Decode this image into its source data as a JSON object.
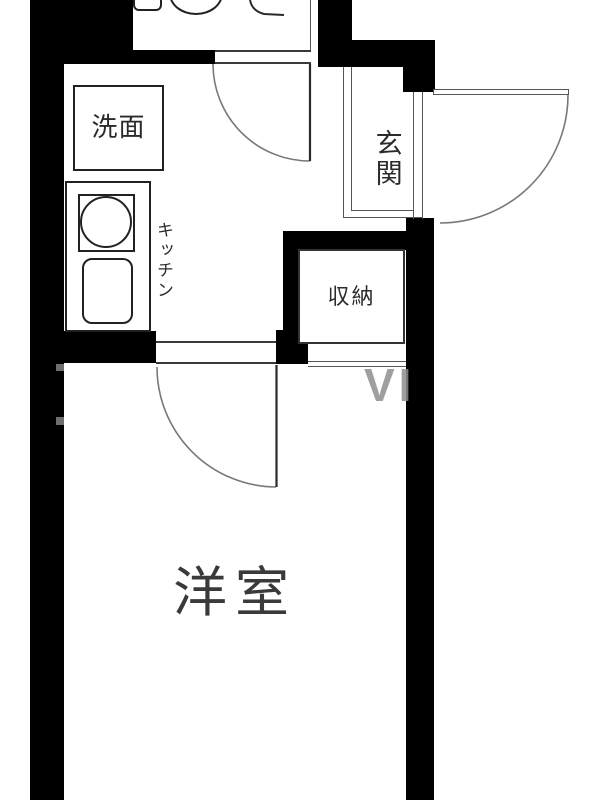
{
  "meta": {
    "kind": "japanese-apartment-floor-plan",
    "width_px": 600,
    "height_px": 800
  },
  "colors": {
    "wall": "#000000",
    "thin_line": "#4a4a4a",
    "door_arc": "#777777",
    "label_text": "#2b2b2b",
    "background": "#ffffff",
    "watermark": "#8f8f8f"
  },
  "rooms": {
    "washroom": {
      "label": "洗面"
    },
    "kitchen": {
      "label": "キッチン"
    },
    "entrance": {
      "label": "玄関"
    },
    "storage": {
      "label": "収納"
    },
    "main_room": {
      "label": "洋室"
    }
  },
  "fixtures": {
    "toilet": "toilet-bowl-icon",
    "cistern": "toilet-tank-icon",
    "bathtub": "bathtub-corner-icon",
    "stove": "stove-burner-icon",
    "sink": "kitchen-sink-icon",
    "basin": "wash-basin-icon"
  },
  "doors": {
    "bathroom_door": "swing-door",
    "entrance_door": "swing-door",
    "main_room_door": "swing-door"
  },
  "watermark": {
    "text": "VI"
  }
}
